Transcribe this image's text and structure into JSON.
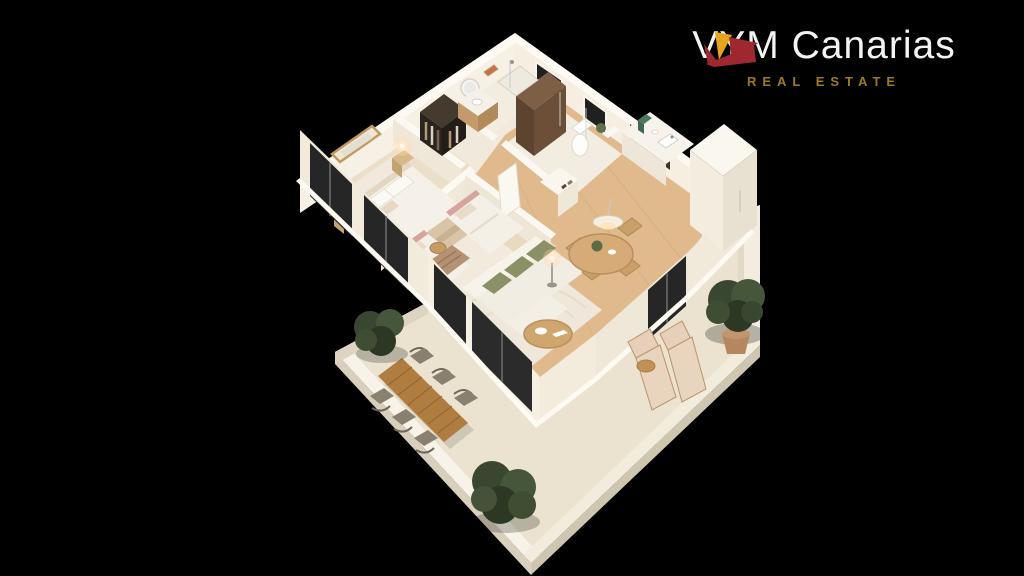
{
  "canvas": {
    "width": 1024,
    "height": 576,
    "background_color": "#000000"
  },
  "logo": {
    "brand": "VYM Canarias",
    "tagline": "REAL ESTATE",
    "brand_color": "#f4f3f1",
    "tagline_color": "#9a7c1e",
    "mark_red": "#9e2731",
    "mark_yellow": "#e7a31d"
  },
  "scene": {
    "type": "isometric-3d-apartment-floorplan-render",
    "palette": {
      "wall_light": "#f7f1e5",
      "wall_shade": "#e6ded0",
      "wood_floor": "#e0b98c",
      "terrace_floor": "#ebe3cf",
      "glass_door_frame": "#262626",
      "tree_green": "#3a4730",
      "outdoor_table_wood": "#b07d40",
      "lamp_glow": "#ffe2b0",
      "accent_pillow_olive": "#8c9066",
      "accent_headboard_blush": "#d8a49e"
    },
    "rooms": [
      {
        "name": "master-bedroom",
        "furniture": [
          "double-bed",
          "nightstand-with-lit-lamp",
          "nightstand-with-lit-lamp",
          "wall-mirror",
          "sliding-glass-doors"
        ]
      },
      {
        "name": "bedroom-2",
        "furniture": [
          "single-bed-blush-headboard",
          "single-bed-blush-headboard",
          "round-side-table",
          "wall-art",
          "glass-door"
        ]
      },
      {
        "name": "walk-in-wardrobe",
        "furniture": [
          "open-shelving-with-clothes"
        ]
      },
      {
        "name": "bathroom-1",
        "furniture": [
          "round-mirror",
          "wood-vanity",
          "walk-in-shower",
          "wall-art"
        ]
      },
      {
        "name": "bathroom-2",
        "furniture": [
          "toilet",
          "walk-in-shower-wood-wall",
          "window",
          "plant"
        ]
      },
      {
        "name": "hallway",
        "furniture": [
          "open-door",
          "book-niche-console"
        ]
      },
      {
        "name": "kitchen",
        "furniture": [
          "counter-with-sink",
          "coffee-machine",
          "built-in-ovens",
          "tall-cabinet"
        ]
      },
      {
        "name": "living-dining",
        "furniture": [
          "sofa-with-olive-cushions",
          "coffee-table",
          "floor-lamp-lit",
          "round-dining-table",
          "dining-chairs",
          "pendant-lamp-lit",
          "rug"
        ]
      },
      {
        "name": "terrace-right",
        "furniture": [
          "sun-lounger",
          "sun-lounger",
          "round-side-table",
          "potted-tree"
        ]
      },
      {
        "name": "terrace-main",
        "furniture": [
          "outdoor-plank-dining-table",
          "outdoor-chairs-x6",
          "tree",
          "tree"
        ]
      }
    ]
  }
}
